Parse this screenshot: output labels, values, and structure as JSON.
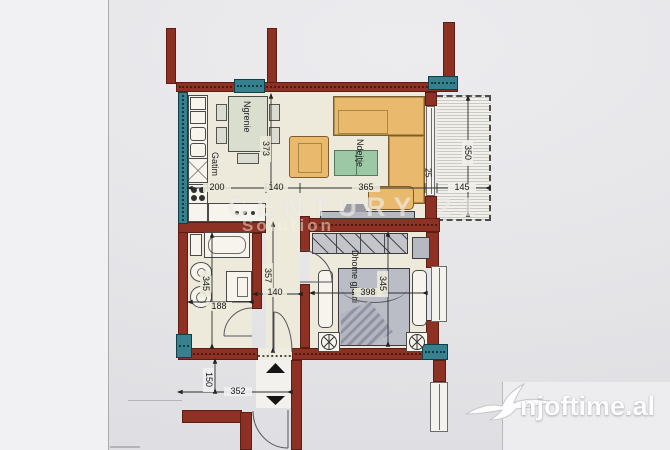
{
  "plan": {
    "rooms": {
      "kitchen_label": "Gatim",
      "dining_label": "Ngrenie",
      "living_label": "Ndejtje",
      "bedroom_label": "Dhome gjumi"
    },
    "dims": {
      "dining_depth": "373",
      "kitchen_width": "200",
      "hall_width": "140",
      "living_width": "365",
      "wall_offset": "25",
      "balcony_width": "145",
      "balcony_depth": "350",
      "hall_depth": "357",
      "hall_width_lower": "140",
      "bath_depth": "345",
      "bath_width": "188",
      "bedroom_width": "398",
      "bedroom_depth": "345",
      "landing_depth": "150",
      "landing_width": "352"
    }
  },
  "watermarks": {
    "center_line1": "CENTURY 21",
    "center_line2": "Solution",
    "brand": "njoftime.al"
  },
  "colors": {
    "wall_red": "#8e3125",
    "column_teal": "#37808d",
    "floor_cream": "#edeadb",
    "furniture_orange": "#e9ba6e",
    "table_green": "#9dc8a5"
  }
}
